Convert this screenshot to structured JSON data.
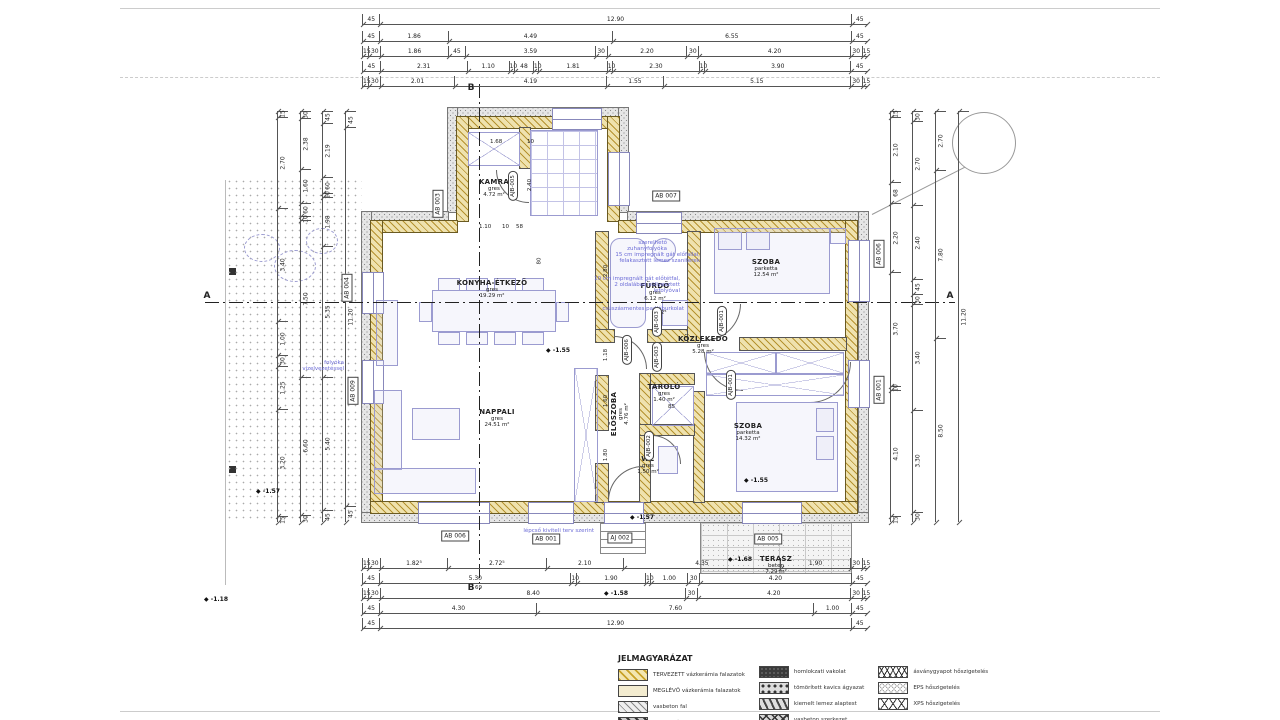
{
  "colors": {
    "masonry_fill": "#efe2ae",
    "masonry_line": "#b5922f",
    "insulation_fill": "#e6e6e6",
    "furniture_line": "#9b9bd0",
    "annotation_blue": "#6b6bd6",
    "dimension_text": "#222222"
  },
  "rooms": [
    {
      "name": "KAMRA",
      "floor": "gres",
      "area": "4.72 m²",
      "x": 494,
      "y": 188,
      "rot": false
    },
    {
      "name": "KONYHA-ÉTKEZŐ",
      "floor": "gres",
      "area": "19.29 m²",
      "x": 492,
      "y": 289,
      "rot": false
    },
    {
      "name": "NAPPALI",
      "floor": "gres",
      "area": "24.51 m²",
      "x": 497,
      "y": 418,
      "rot": false
    },
    {
      "name": "FÜRDŐ",
      "floor": "gres",
      "area": "6.12 m²",
      "x": 655,
      "y": 292,
      "rot": false
    },
    {
      "name": "ELŐSZOBA",
      "floor": "gres",
      "area": "4.76 m²",
      "x": 620,
      "y": 414,
      "rot": true
    },
    {
      "name": "SZOBA",
      "floor": "parketta",
      "area": "12.54 m²",
      "x": 766,
      "y": 268,
      "rot": false
    },
    {
      "name": "KÖZLEKEDŐ",
      "floor": "gres",
      "area": "5.28 m²",
      "x": 703,
      "y": 345,
      "rot": false
    },
    {
      "name": "TÁROLÓ",
      "floor": "gres",
      "area": "1.40 m²",
      "x": 664,
      "y": 393,
      "rot": false
    },
    {
      "name": "WC",
      "floor": "gres",
      "area": "1.50 m²",
      "x": 648,
      "y": 465,
      "rot": false
    },
    {
      "name": "SZOBA",
      "floor": "parketta",
      "area": "14.32 m²",
      "x": 748,
      "y": 432,
      "rot": false
    },
    {
      "name": "TERASZ",
      "floor": "beton",
      "area": "7.29 m²",
      "x": 776,
      "y": 565,
      "rot": false
    }
  ],
  "dims": {
    "top": [
      {
        "y": 14,
        "labels": [
          "45",
          "12.90",
          "45"
        ]
      },
      {
        "y": 31,
        "labels": [
          "45",
          "1.86",
          "4.49",
          "6.55",
          "45"
        ]
      },
      {
        "y": 46,
        "labels": [
          "15",
          "30",
          "1.86",
          "45",
          "3.59",
          "30",
          "2.20",
          "30",
          "4.20",
          "30",
          "15"
        ]
      },
      {
        "y": 61,
        "labels": [
          "45",
          "2.31",
          "1.10",
          "10",
          "48",
          "10",
          "1.81",
          "10",
          "2.30",
          "10",
          "3.90",
          "45"
        ]
      },
      {
        "y": 76,
        "labels": [
          "15",
          "30",
          "2.01",
          "4.19",
          "1.55",
          "5.15",
          "30",
          "15"
        ]
      }
    ],
    "bottom": [
      {
        "y": 558,
        "labels": [
          "15",
          "30",
          "1.82⁵",
          "2.72⁵",
          "2.10",
          "4.35",
          "1.90",
          "30",
          "15"
        ]
      },
      {
        "y": 573,
        "labels": [
          "45",
          "5.30",
          "10",
          "1.90",
          "10",
          "1.00",
          "30",
          "4.20",
          "45"
        ]
      },
      {
        "y": 588,
        "labels": [
          "15",
          "30",
          "8.40",
          "30",
          "4.20",
          "30",
          "15"
        ]
      },
      {
        "y": 603,
        "labels": [
          "45",
          "4.30",
          "7.60",
          "1.00",
          "45"
        ]
      },
      {
        "y": 618,
        "labels": [
          "45",
          "12.90",
          "45"
        ]
      }
    ],
    "left": [
      {
        "x": 277,
        "labels": [
          "15",
          "2.70",
          "3.40",
          "1.00",
          "30",
          "1.25",
          "3.20",
          "15"
        ]
      },
      {
        "x": 300,
        "labels": [
          "30",
          "2.38",
          "1.60",
          "60",
          "10",
          "7.50",
          "6.60",
          "30"
        ]
      },
      {
        "x": 322,
        "labels": [
          "45",
          "2.19",
          "60",
          "10",
          "1.98",
          "5.35",
          "5.40",
          "45"
        ]
      },
      {
        "x": 345,
        "labels": [
          "45",
          "11.20",
          "45"
        ]
      }
    ],
    "right": [
      {
        "x": 890,
        "labels": [
          "15",
          "2.10",
          "68",
          "2.20",
          "3.70",
          "10",
          "4.10",
          "15"
        ]
      },
      {
        "x": 912,
        "labels": [
          "30",
          "2.70",
          "2.40",
          "45",
          "30",
          "3.40",
          "3.30",
          "30"
        ]
      },
      {
        "x": 935,
        "labels": [
          "2.70",
          "7.80",
          "8.50"
        ]
      },
      {
        "x": 958,
        "labels": [
          "11.20"
        ]
      }
    ]
  },
  "inline_dims": [
    {
      "t": "1.68",
      "x": 490,
      "y": 139,
      "rot": false
    },
    {
      "t": "10",
      "x": 527,
      "y": 139,
      "rot": false
    },
    {
      "t": "1.10",
      "x": 479,
      "y": 224,
      "rot": false
    },
    {
      "t": "10",
      "x": 502,
      "y": 224,
      "rot": false
    },
    {
      "t": "58",
      "x": 516,
      "y": 224,
      "rot": false
    },
    {
      "t": "2.40",
      "x": 524,
      "y": 182,
      "rot": true
    },
    {
      "t": "80",
      "x": 536,
      "y": 258,
      "rot": true
    },
    {
      "t": "2.80",
      "x": 600,
      "y": 268,
      "rot": true
    },
    {
      "t": "1.18",
      "x": 600,
      "y": 352,
      "rot": true
    },
    {
      "t": "1.60",
      "x": 600,
      "y": 398,
      "rot": true
    },
    {
      "t": "1.80",
      "x": 600,
      "y": 452,
      "rot": true
    },
    {
      "t": "1.12⁵",
      "x": 652,
      "y": 310,
      "rot": false
    },
    {
      "t": "85",
      "x": 668,
      "y": 404,
      "rot": false
    },
    {
      "t": "69",
      "x": 475,
      "y": 585,
      "rot": false
    }
  ],
  "tags_rect": [
    {
      "t": "AB 007",
      "x": 666,
      "y": 196,
      "rot": false
    },
    {
      "t": "AB 003",
      "x": 438,
      "y": 204,
      "rot": true
    },
    {
      "t": "AB 004",
      "x": 347,
      "y": 288,
      "rot": true
    },
    {
      "t": "AB 009",
      "x": 353,
      "y": 391,
      "rot": true
    },
    {
      "t": "AB 006",
      "x": 879,
      "y": 254,
      "rot": true
    },
    {
      "t": "AB 001",
      "x": 879,
      "y": 390,
      "rot": true
    },
    {
      "t": "AB 006",
      "x": 455,
      "y": 536,
      "rot": false
    },
    {
      "t": "AB 001",
      "x": 546,
      "y": 539,
      "rot": false
    },
    {
      "t": "AJ 002",
      "x": 620,
      "y": 538,
      "rot": false
    },
    {
      "t": "AB 005",
      "x": 768,
      "y": 539,
      "rot": false
    }
  ],
  "tags_oval": [
    {
      "t": "AJB-005",
      "x": 513,
      "y": 186
    },
    {
      "t": "AJB-003",
      "x": 657,
      "y": 322
    },
    {
      "t": "AJB-006",
      "x": 627,
      "y": 350
    },
    {
      "t": "AJB-003",
      "x": 657,
      "y": 357
    },
    {
      "t": "AJB-001",
      "x": 722,
      "y": 321
    },
    {
      "t": "AJB-001",
      "x": 731,
      "y": 385
    },
    {
      "t": "AJB-002",
      "x": 649,
      "y": 446
    }
  ],
  "levels": [
    {
      "t": "-1.55",
      "x": 546,
      "y": 347
    },
    {
      "t": "-1.57",
      "x": 256,
      "y": 488
    },
    {
      "t": "-1.55",
      "x": 744,
      "y": 477
    },
    {
      "t": "-1.57",
      "x": 630,
      "y": 514
    },
    {
      "t": "-1.68",
      "x": 728,
      "y": 556
    },
    {
      "t": "-1.58",
      "x": 604,
      "y": 590
    },
    {
      "t": "-1.18",
      "x": 204,
      "y": 596
    }
  ],
  "notes_blue": [
    {
      "t": "szerelhető zuhanyfolyóka",
      "x": 597,
      "y": 240,
      "w": 70
    },
    {
      "t": "15 cm impregnált gát előfallal, felakasztott lemez szaniterek",
      "x": 612,
      "y": 252,
      "w": 88
    },
    {
      "t": "10 cm impregnált gát előtétfal, 2 oldalában süllyesztett lefolyóval",
      "x": 594,
      "y": 276,
      "w": 86
    },
    {
      "t": "csúszásmentes padlóburkolat",
      "x": 600,
      "y": 306,
      "w": 84
    },
    {
      "t": "folyóka vízelvezetéssel",
      "x": 286,
      "y": 360,
      "w": 58
    },
    {
      "t": "lépcső kiviteli terv szerint",
      "x": 484,
      "y": 528,
      "w": 110
    }
  ],
  "section_marks": [
    {
      "t": "A",
      "x": 207,
      "y": 296
    },
    {
      "t": "A",
      "x": 950,
      "y": 296
    },
    {
      "t": "B",
      "x": 471,
      "y": 88
    },
    {
      "t": "B",
      "x": 471,
      "y": 588
    }
  ],
  "legend": {
    "title": "JELMAGYARÁZAT",
    "columns": [
      [
        {
          "pattern": "yellow-hatch",
          "label": "TERVEZETT vázkerámia falazatok"
        },
        {
          "pattern": "beige",
          "label": "MEGLÉVŐ vázkerámia falazatok"
        },
        {
          "pattern": "gray-hatch",
          "label": "vasbeton fal"
        },
        {
          "pattern": "dark-hatch",
          "label": "bontandó falszakasz"
        }
      ],
      [
        {
          "pattern": "solid-dark",
          "label": "homlokzati vakolat"
        },
        {
          "pattern": "gravel",
          "label": "tömörített kavics ágyazat"
        },
        {
          "pattern": "diag-dark",
          "label": "kiemelt lemez alaptest"
        },
        {
          "pattern": "rubble",
          "label": "vasbeton szerkezet"
        }
      ],
      [
        {
          "pattern": "wool",
          "label": "ásványgyapot hőszigetelés"
        },
        {
          "pattern": "eps",
          "label": "EPS hőszigetelés"
        },
        {
          "pattern": "xps",
          "label": "XPS hőszigetelés"
        }
      ]
    ]
  }
}
